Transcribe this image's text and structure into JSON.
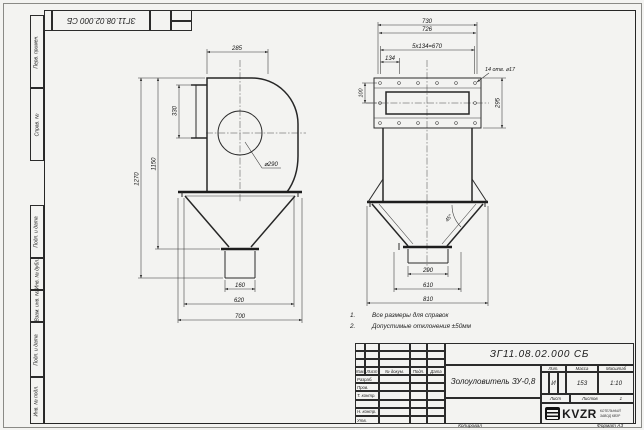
{
  "colors": {
    "paper": "#f3f3f1",
    "line": "#2b2b2b"
  },
  "top_stamp": {
    "doc_number": "ЗГ11.08.02.000 СБ"
  },
  "sidebar": {
    "labels_top": [
      "Перв. примен.",
      "Справ. №"
    ],
    "labels_bottom": [
      "Подп. и дата",
      "Инв. № дубл.",
      "Взам. инв. №",
      "Подп. и дата",
      "Инв. № подл."
    ]
  },
  "views": {
    "left": {
      "dims": {
        "top_width": "285",
        "inlet_height": "330",
        "body_height": "1150",
        "total_height": "1270",
        "circle_dia": "⌀290",
        "outlet_width": "160",
        "flange_width": "620",
        "base_width": "700"
      }
    },
    "right": {
      "dims": {
        "flange_outer": "730",
        "flange_inner": "726",
        "hole_span": "5x134=670",
        "hole_step": "134",
        "holes_note": "14 отв. ⌀17",
        "hole_offset": "100",
        "flange_height": "295",
        "cone_angle": "45°",
        "outlet_width": "290",
        "mid_width": "610",
        "base_width": "810"
      }
    }
  },
  "notes": {
    "items": [
      {
        "num": "1.",
        "text": "Все размеры для справок"
      },
      {
        "num": "2.",
        "text": "Допустимые отклонения ±50мм"
      }
    ]
  },
  "title_block": {
    "doc_number": "ЗГ11.08.02.000 СБ",
    "product_name": "Золоуловитель ЗУ-0,8",
    "col_izm": "Изм.",
    "col_list": "Лист",
    "col_doc": "№ докум.",
    "col_sign": "Подп.",
    "col_date": "Дата",
    "row_developed": "Разраб.",
    "row_checked": "Пров.",
    "row_tcontrol": "Т. контр.",
    "row_ncontrol": "Н. контр.",
    "row_approved": "Утв.",
    "lit_label": "Лит.",
    "lit_value": "И",
    "mass_label": "Масса",
    "mass_value": "153",
    "scale_label": "Масштаб",
    "scale_value": "1:10",
    "sheet_label": "Лист",
    "sheets_label": "Листов",
    "sheets_value": "1",
    "company_logo": "KVZR",
    "company_name": "КОТЕЛЬНЫЙ ЗАВОД КВЗР",
    "copied": "Копировал",
    "format": "Формат А3"
  }
}
